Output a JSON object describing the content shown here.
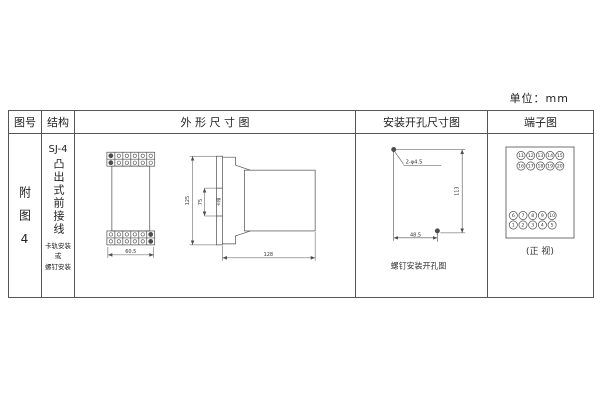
{
  "unit_label": "单位：mm",
  "table": {
    "headers": {
      "fig_no": "图号",
      "structure": "结构",
      "outline": "外 形 尺 寸 图",
      "mounting": "安装开孔尺寸图",
      "terminal": "端子图"
    },
    "row": {
      "fig_no": "附图4",
      "structure": {
        "model": "SJ-4",
        "type_vertical": "凸出式前接线",
        "mount_note_lines": [
          "卡轨安装",
          "或",
          "螺钉安装"
        ]
      }
    }
  },
  "outline_drawing": {
    "front_width_dim": "60.5",
    "side_height_dim": "125",
    "slot_dim": "75",
    "slot_label": "卡槽",
    "side_depth_dim": "128"
  },
  "mounting_drawing": {
    "hole_label": "2-φ4.5",
    "vertical_dim": "113",
    "horizontal_dim": "48.5",
    "caption": "螺钉安装开孔图"
  },
  "terminal_diagram": {
    "top_rows": [
      [
        "11",
        "12",
        "13",
        "14",
        "15"
      ],
      [
        "16",
        "17",
        "18",
        "19",
        "20"
      ]
    ],
    "bottom_rows": [
      [
        "6",
        "7",
        "8",
        "9",
        "10"
      ],
      [
        "1",
        "2",
        "3",
        "4",
        "5"
      ]
    ],
    "caption": "(正 视)"
  },
  "colors": {
    "line": "#4d4d4d",
    "text": "#333333",
    "background": "#ffffff"
  }
}
